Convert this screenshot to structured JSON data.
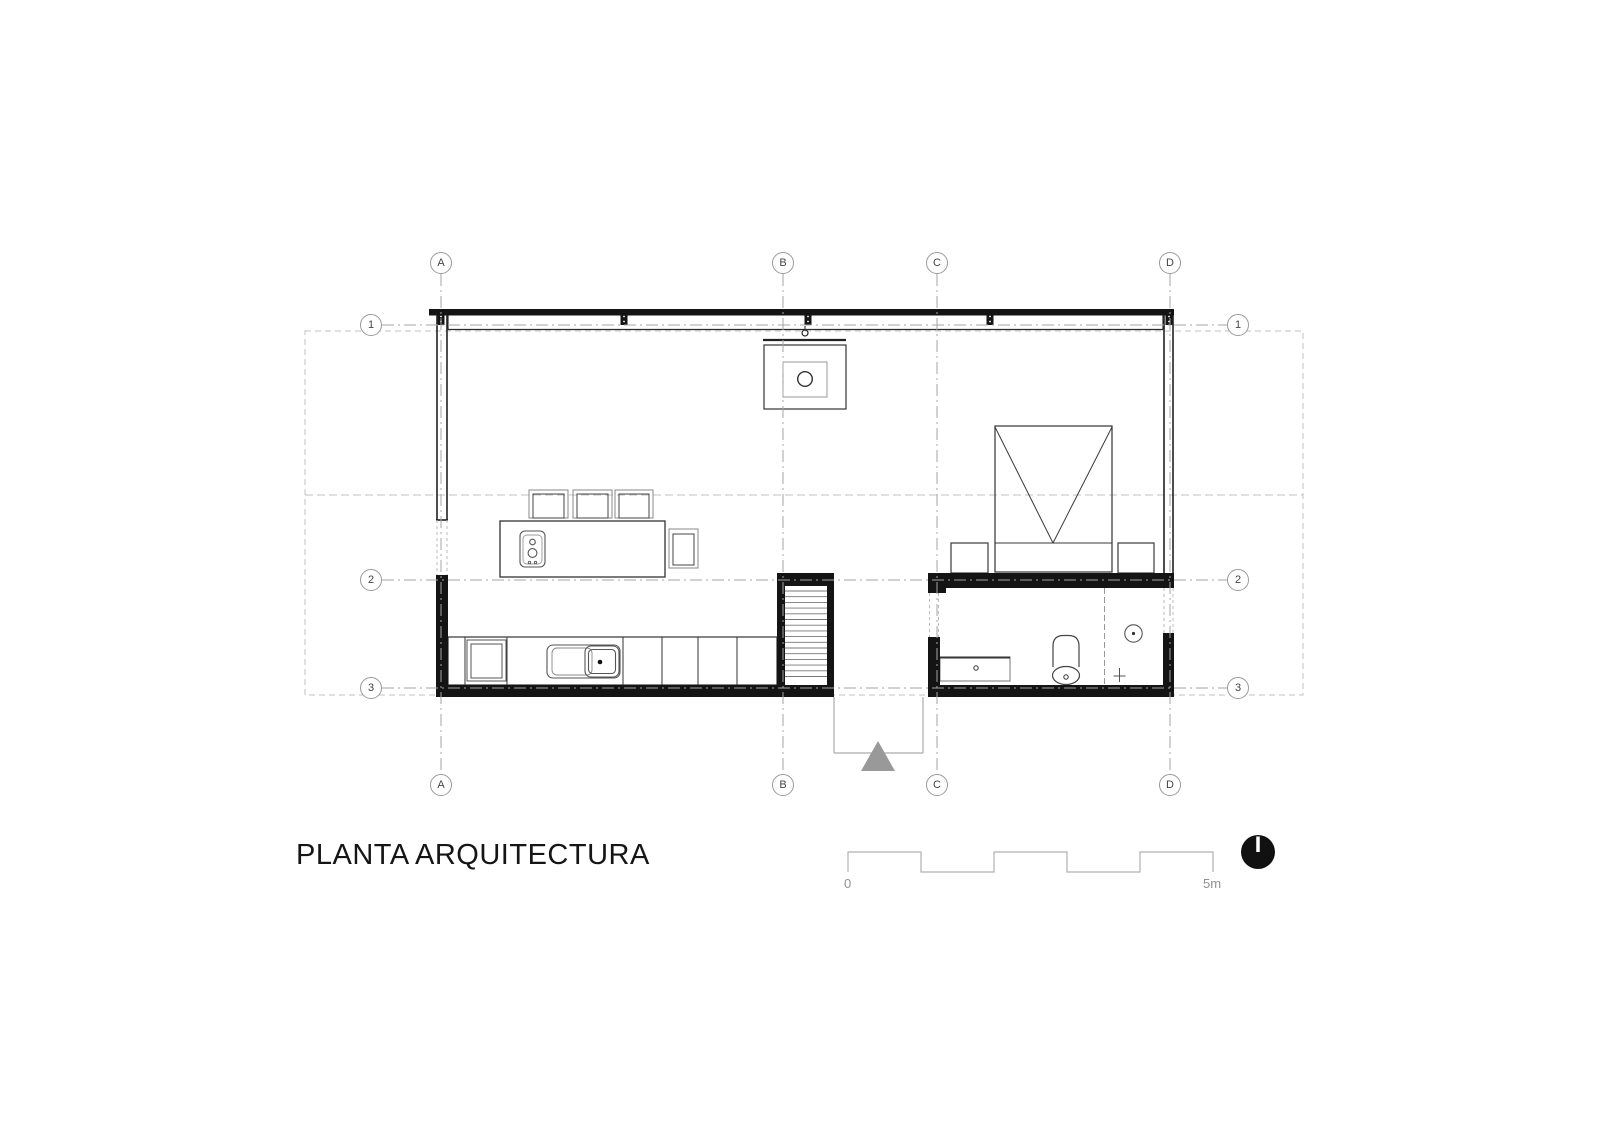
{
  "title": "PLANTA ARQUITECTURA",
  "grid": {
    "column_axes": [
      "A",
      "B",
      "C",
      "D"
    ],
    "row_axes": [
      "1",
      "2",
      "3"
    ]
  },
  "scale_bar": {
    "start_label": "0",
    "end_label": "5m"
  },
  "icons": {
    "north_indicator": "filled-black-circle-with-white-needle",
    "entry_arrow": "gray-upward-triangle"
  },
  "colors": {
    "wall_fill": "#141414",
    "primary_line": "#333333",
    "furniture_line": "#555555",
    "grid_dashdot_line": "#a5a5a5",
    "roof_dash_line": "#c0c0c0",
    "porch_line": "#ababab",
    "entry_arrow_fill": "#999999",
    "label_gray": "#909090"
  }
}
